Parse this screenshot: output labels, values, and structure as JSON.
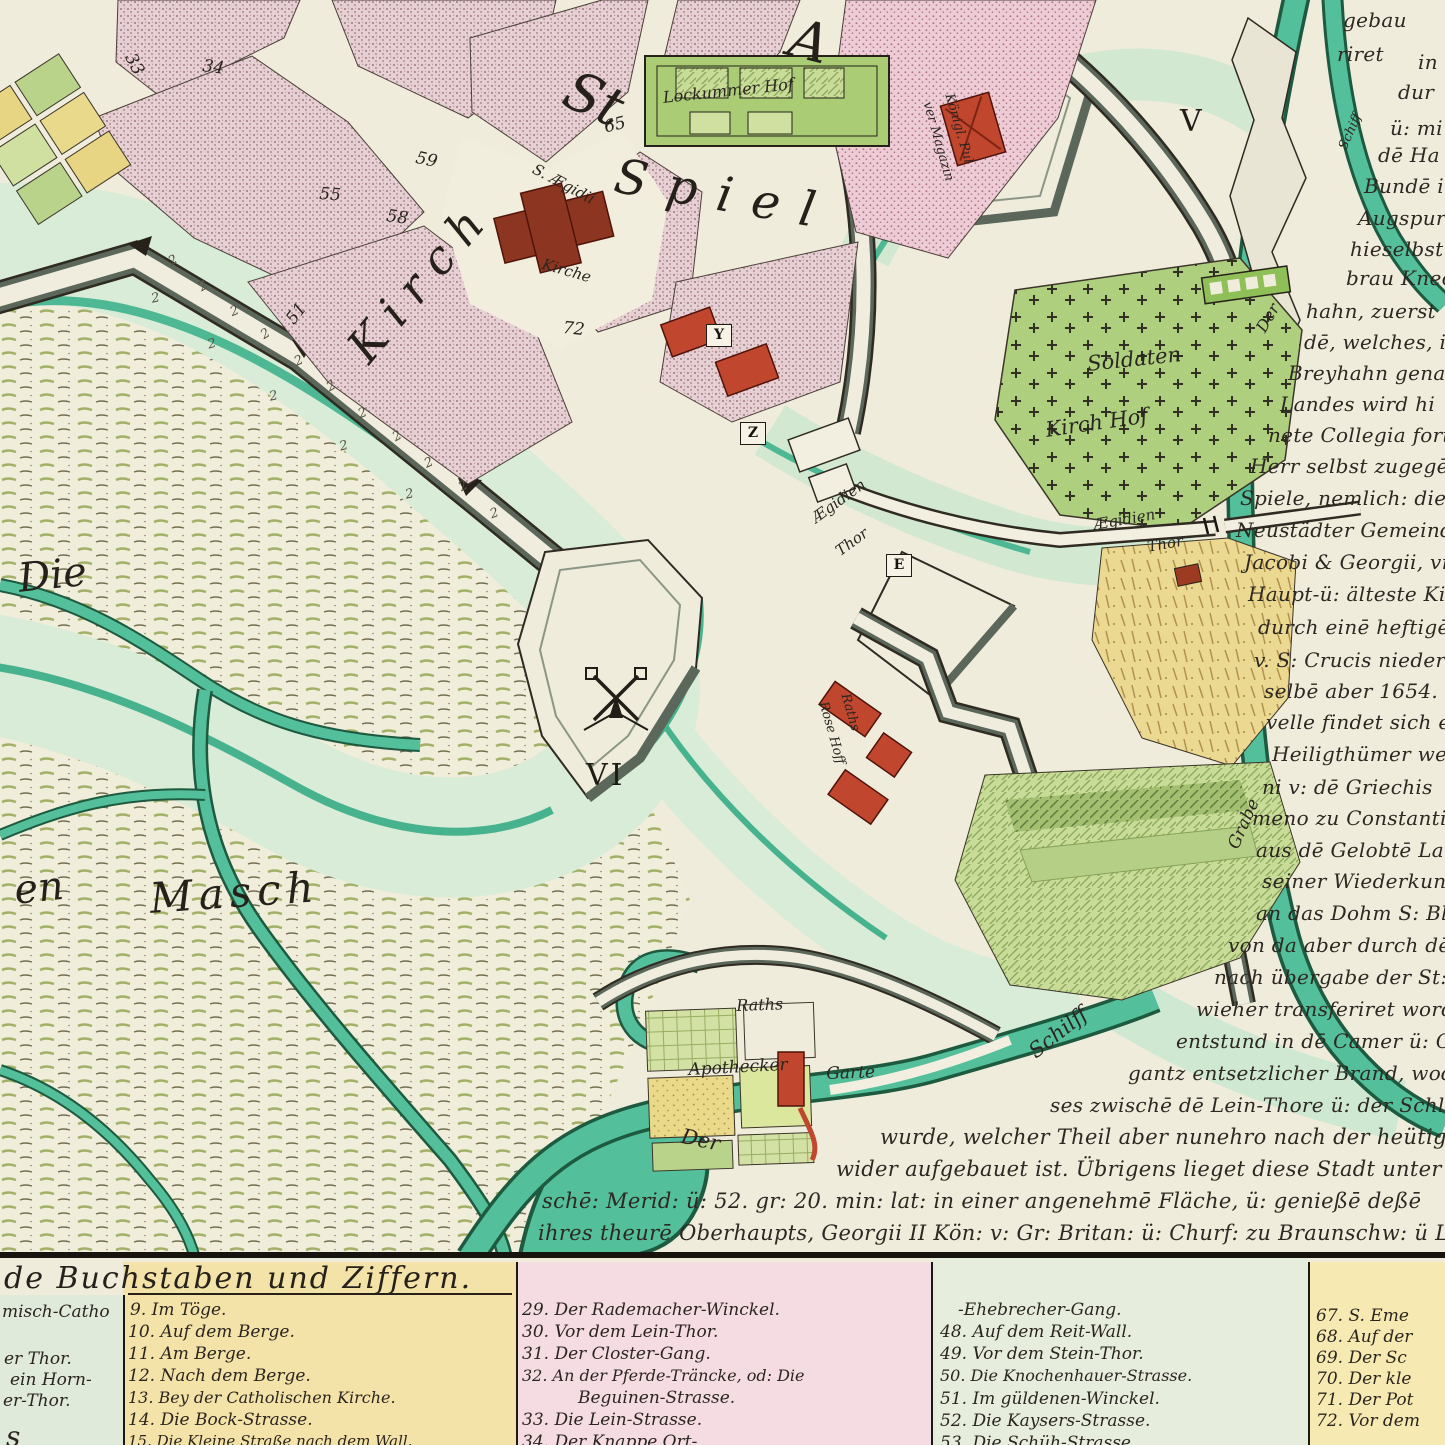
{
  "palette": {
    "parchment": "#f0ecdb",
    "moat": "#d9ecd7",
    "canal": "#54bf9b",
    "canal_dark": "#1d5a40",
    "pink_block": "#e7d0d4",
    "rose_block": "#edccd6",
    "garden_green": "#b9d48a",
    "garden_yellow": "#e9d88c",
    "cemetery": "#adcf7e",
    "wall_light": "#f0edde",
    "wall_shade": "#6b7866",
    "red_building": "#c0472e",
    "church_red": "#8c3520",
    "ink": "#2b2521",
    "legend_green": "#dfeadb",
    "legend_yellow": "#f3e3a8",
    "legend_pink": "#f4dce2",
    "legend_palegreen": "#e6eddd",
    "legend_yellow2": "#f7e9b2"
  },
  "map": {
    "labels": [
      {
        "t": "St",
        "x": 580,
        "y": 58,
        "fs": 54,
        "rot": 24,
        "cls": "big"
      },
      {
        "t": "A",
        "x": 798,
        "y": 6,
        "fs": 54,
        "rot": 14,
        "cls": "big"
      },
      {
        "t": "Kirch",
        "x": 336,
        "y": 338,
        "fs": 46,
        "rot": -50,
        "ls": 14,
        "cls": "big"
      },
      {
        "t": "Spiel",
        "x": 620,
        "y": 148,
        "fs": 48,
        "rot": 10,
        "ls": 20,
        "cls": "big"
      },
      {
        "t": "S. Ægidii",
        "x": 538,
        "y": 160,
        "fs": 15,
        "rot": 28
      },
      {
        "t": "Kirche",
        "x": 545,
        "y": 255,
        "fs": 15,
        "rot": 16
      },
      {
        "t": "Lockummer Hof",
        "x": 662,
        "y": 88,
        "fs": 16,
        "rot": -6
      },
      {
        "t": "Königl. Pul",
        "x": 956,
        "y": 92,
        "fs": 13,
        "rot": 74
      },
      {
        "t": "ver Magazin",
        "x": 934,
        "y": 100,
        "fs": 13,
        "rot": 74
      },
      {
        "t": "Soldaten",
        "x": 1086,
        "y": 352,
        "fs": 21,
        "rot": -6
      },
      {
        "t": "Kirch Hof",
        "x": 1044,
        "y": 418,
        "fs": 21,
        "rot": -8
      },
      {
        "t": "Ægidien",
        "x": 808,
        "y": 512,
        "fs": 15,
        "rot": -36
      },
      {
        "t": "Thor",
        "x": 832,
        "y": 545,
        "fs": 15,
        "rot": -36
      },
      {
        "t": "Ægidien",
        "x": 1092,
        "y": 516,
        "fs": 15,
        "rot": -10
      },
      {
        "t": "Thor",
        "x": 1146,
        "y": 538,
        "fs": 15,
        "rot": -10
      },
      {
        "t": "Raths",
        "x": 852,
        "y": 692,
        "fs": 13,
        "rot": 74
      },
      {
        "t": "Rose Hoff",
        "x": 830,
        "y": 700,
        "fs": 13,
        "rot": 74
      },
      {
        "t": "Die",
        "x": 16,
        "y": 556,
        "fs": 40,
        "rot": -6,
        "cls": "big"
      },
      {
        "t": "en",
        "x": 12,
        "y": 868,
        "fs": 40,
        "rot": -6,
        "cls": "big"
      },
      {
        "t": "Masch",
        "x": 148,
        "y": 874,
        "fs": 42,
        "rot": -4,
        "ls": 6,
        "cls": "big"
      },
      {
        "t": "Raths",
        "x": 736,
        "y": 996,
        "fs": 16,
        "rot": -2
      },
      {
        "t": "Apothecker",
        "x": 688,
        "y": 1060,
        "fs": 17,
        "rot": -3
      },
      {
        "t": "Garte",
        "x": 826,
        "y": 1064,
        "fs": 17,
        "rot": -2
      },
      {
        "t": "Der",
        "x": 684,
        "y": 1124,
        "fs": 21,
        "rot": 12
      },
      {
        "t": "Schilff",
        "x": 1024,
        "y": 1044,
        "fs": 21,
        "rot": -38
      },
      {
        "t": "Der",
        "x": 1252,
        "y": 326,
        "fs": 16,
        "rot": -60
      },
      {
        "t": "Grabe",
        "x": 1224,
        "y": 844,
        "fs": 17,
        "rot": -66
      },
      {
        "t": "Schiff",
        "x": 1336,
        "y": 146,
        "fs": 13,
        "rot": -66
      }
    ],
    "numbers": [
      {
        "t": "33",
        "x": 138,
        "y": 50,
        "rot": 62
      },
      {
        "t": "34",
        "x": 204,
        "y": 56,
        "rot": 8
      },
      {
        "t": "55",
        "x": 320,
        "y": 184,
        "rot": 4
      },
      {
        "t": "58",
        "x": 388,
        "y": 206,
        "rot": 8
      },
      {
        "t": "59",
        "x": 418,
        "y": 148,
        "rot": 12
      },
      {
        "t": "65",
        "x": 602,
        "y": 118,
        "rot": -14
      },
      {
        "t": "72",
        "x": 564,
        "y": 318,
        "rot": 6
      },
      {
        "t": "51",
        "x": 282,
        "y": 316,
        "rot": -52
      },
      {
        "t": "V",
        "x": 1180,
        "y": 104,
        "cls": "roman"
      },
      {
        "t": "VI",
        "x": 586,
        "y": 758,
        "cls": "roman"
      }
    ],
    "boxes": [
      {
        "t": "Y",
        "x": 706,
        "y": 324
      },
      {
        "t": "Z",
        "x": 740,
        "y": 422
      },
      {
        "t": "E",
        "x": 886,
        "y": 554
      }
    ],
    "reeds": [
      {
        "t": "2",
        "x": 166,
        "y": 256,
        "rot": -28
      },
      {
        "t": "2",
        "x": 150,
        "y": 292,
        "rot": -12
      },
      {
        "t": "2",
        "x": 196,
        "y": 282,
        "rot": -30
      },
      {
        "t": "2",
        "x": 228,
        "y": 306,
        "rot": -22
      },
      {
        "t": "2",
        "x": 206,
        "y": 338,
        "rot": -15
      },
      {
        "t": "2",
        "x": 258,
        "y": 330,
        "rot": -32
      },
      {
        "t": "2",
        "x": 292,
        "y": 356,
        "rot": -24
      },
      {
        "t": "2",
        "x": 268,
        "y": 390,
        "rot": -12
      },
      {
        "t": "2",
        "x": 324,
        "y": 382,
        "rot": -30
      },
      {
        "t": "2",
        "x": 356,
        "y": 408,
        "rot": -22
      },
      {
        "t": "2",
        "x": 338,
        "y": 440,
        "rot": -14
      },
      {
        "t": "2",
        "x": 390,
        "y": 432,
        "rot": -30
      },
      {
        "t": "2",
        "x": 422,
        "y": 458,
        "rot": -24
      },
      {
        "t": "2",
        "x": 404,
        "y": 488,
        "rot": -12
      },
      {
        "t": "2",
        "x": 456,
        "y": 482,
        "rot": -30
      },
      {
        "t": "2",
        "x": 488,
        "y": 508,
        "rot": -20
      }
    ]
  },
  "rtext": {
    "lines": [
      {
        "t": "gebau",
        "x": 1343,
        "y": 8
      },
      {
        "t": "riret",
        "x": 1337,
        "y": 42
      },
      {
        "t": "in",
        "x": 1418,
        "y": 50
      },
      {
        "t": "dur",
        "x": 1398,
        "y": 80
      },
      {
        "t": "ü: mi",
        "x": 1390,
        "y": 116
      },
      {
        "t": "dē Ha",
        "x": 1378,
        "y": 143
      },
      {
        "t": "Bundē i",
        "x": 1364,
        "y": 174
      },
      {
        "t": "Augspurg",
        "x": 1358,
        "y": 206
      },
      {
        "t": "hieselbst y",
        "x": 1350,
        "y": 237
      },
      {
        "t": "brau Knech",
        "x": 1346,
        "y": 266
      },
      {
        "t": "hahn, zuerst",
        "x": 1306,
        "y": 299
      },
      {
        "t": "dē, welches, ih",
        "x": 1304,
        "y": 330
      },
      {
        "t": "Breyhahn gena",
        "x": 1288,
        "y": 361
      },
      {
        "t": "Landes wird hi",
        "x": 1280,
        "y": 392
      },
      {
        "t": "nete Collegia forts",
        "x": 1268,
        "y": 423
      },
      {
        "t": "Herr selbst zugegē",
        "x": 1250,
        "y": 454
      },
      {
        "t": "Spiele, nemlich: die",
        "x": 1240,
        "y": 486
      },
      {
        "t": "Neustädter Gemeind",
        "x": 1236,
        "y": 518
      },
      {
        "t": "Jacobi & Georgii, vn",
        "x": 1244,
        "y": 550
      },
      {
        "t": "Haupt-ü: älteste Kir",
        "x": 1248,
        "y": 582
      },
      {
        "t": "durch einē heftigē",
        "x": 1258,
        "y": 615
      },
      {
        "t": "v. S: Crucis niederg",
        "x": 1254,
        "y": 648
      },
      {
        "t": "selbē aber 1654. u",
        "x": 1264,
        "y": 679
      },
      {
        "t": "velle findet sich e",
        "x": 1266,
        "y": 710
      },
      {
        "t": "Heiligthümer we",
        "x": 1272,
        "y": 742
      },
      {
        "t": "ni v: dē Griechis",
        "x": 1262,
        "y": 775
      },
      {
        "t": "meno zu Constanti",
        "x": 1252,
        "y": 806
      },
      {
        "t": "aus dē Gelobtē La",
        "x": 1256,
        "y": 838
      },
      {
        "t": "seiner Wiederkunft",
        "x": 1262,
        "y": 869
      },
      {
        "t": "an das Dohm S: Bla",
        "x": 1256,
        "y": 901
      },
      {
        "t": "von da aber durch dē",
        "x": 1228,
        "y": 933
      },
      {
        "t": "nach übergabe der St:",
        "x": 1214,
        "y": 965
      },
      {
        "t": "wieher transferiret word",
        "x": 1196,
        "y": 997
      },
      {
        "t": "entstund in dē Camer ü: Canze",
        "x": 1176,
        "y": 1029
      },
      {
        "t": "gantz entsetzlicher Brand, wodurch",
        "x": 1128,
        "y": 1061
      },
      {
        "t": "ses zwischē dē Lein-Thore ü: der Schloß-",
        "x": 1050,
        "y": 1093
      },
      {
        "t": "wurde, welcher Theil aber nunehro nach der heütig.",
        "x": 880,
        "y": 1125,
        "cls": "wide"
      },
      {
        "t": "wider aufgebauet ist. Übrigens lieget diese Stadt unter dē 33. gr: 3",
        "x": 836,
        "y": 1157,
        "cls": "wide"
      },
      {
        "t": "schē: Merid: ü: 52. gr: 20. min: lat: in einer angenehmē Fläche, ü: genießē deßē",
        "x": 542,
        "y": 1189,
        "cls": "wide"
      },
      {
        "t": "ihres theurē Oberhaupts, Georgii II Kön: v: Gr: Britan: ü: Churf: zu Braunschw: ü Lüneburg alle e",
        "x": 538,
        "y": 1221,
        "cls": "wide"
      }
    ]
  },
  "legend": {
    "title": "de Buchstaben und Ziffern.",
    "col0": {
      "items": [
        {
          "t": "misch-Catho",
          "x": 2,
          "y": 1302
        },
        {
          "t": "er Thor.",
          "x": 4,
          "y": 1349
        },
        {
          "t": "ein Horn-",
          "x": 10,
          "y": 1370
        },
        {
          "t": "er-Thor.",
          "x": 3,
          "y": 1391
        },
        {
          "t": "s",
          "x": 6,
          "y": 1420,
          "fs": 28
        }
      ]
    },
    "col1": {
      "items": [
        {
          "t": "9. Im Töge.",
          "x": 130,
          "y": 1300
        },
        {
          "t": "10. Auf dem Berge.",
          "x": 128,
          "y": 1322
        },
        {
          "t": "11. Am Berge.",
          "x": 128,
          "y": 1344
        },
        {
          "t": "12. Nach dem Berge.",
          "x": 128,
          "y": 1366
        },
        {
          "t": "13. Bey der Catholischen Kirche.",
          "x": 128,
          "y": 1388,
          "fs": 16
        },
        {
          "t": "14. Die Bock-Strasse.",
          "x": 128,
          "y": 1410
        },
        {
          "t": "15. Die Kleine Straße nach dem Wall.",
          "x": 128,
          "y": 1432,
          "fs": 15
        }
      ]
    },
    "col2": {
      "items": [
        {
          "t": "29. Der Rademacher-Winckel.",
          "x": 522,
          "y": 1300
        },
        {
          "t": "30. Vor dem Lein-Thor.",
          "x": 522,
          "y": 1322
        },
        {
          "t": "31. Der Closter-Gang.",
          "x": 522,
          "y": 1344
        },
        {
          "t": "32. An der Pferde-Träncke, od: Die",
          "x": 522,
          "y": 1366,
          "fs": 16
        },
        {
          "t": "Beguinen-Strasse.",
          "x": 578,
          "y": 1388
        },
        {
          "t": "33. Die Lein-Strasse.",
          "x": 522,
          "y": 1410
        },
        {
          "t": "34. Der Knappe Ort-",
          "x": 522,
          "y": 1432
        }
      ]
    },
    "col3": {
      "items": [
        {
          "t": "-Ehebrecher-Gang.",
          "x": 958,
          "y": 1300
        },
        {
          "t": "48. Auf dem Reit-Wall.",
          "x": 940,
          "y": 1322
        },
        {
          "t": "49. Vor dem Stein-Thor.",
          "x": 940,
          "y": 1344
        },
        {
          "t": "50. Die Knochenhauer-Strasse.",
          "x": 940,
          "y": 1366,
          "fs": 16
        },
        {
          "t": "51. Im güldenen-Winckel.",
          "x": 940,
          "y": 1389
        },
        {
          "t": "52. Die Kaysers-Strasse.",
          "x": 940,
          "y": 1411
        },
        {
          "t": "53. Die Schüh-Strasse",
          "x": 940,
          "y": 1433
        }
      ]
    },
    "col4": {
      "items": [
        {
          "t": "67. S. Eme",
          "x": 1316,
          "y": 1306
        },
        {
          "t": "68. Auf der",
          "x": 1316,
          "y": 1327
        },
        {
          "t": "69. Der Sc",
          "x": 1316,
          "y": 1348
        },
        {
          "t": "70. Der kle",
          "x": 1316,
          "y": 1369
        },
        {
          "t": "71. Der Pot",
          "x": 1316,
          "y": 1390
        },
        {
          "t": "72. Vor dem",
          "x": 1316,
          "y": 1411
        }
      ]
    }
  }
}
